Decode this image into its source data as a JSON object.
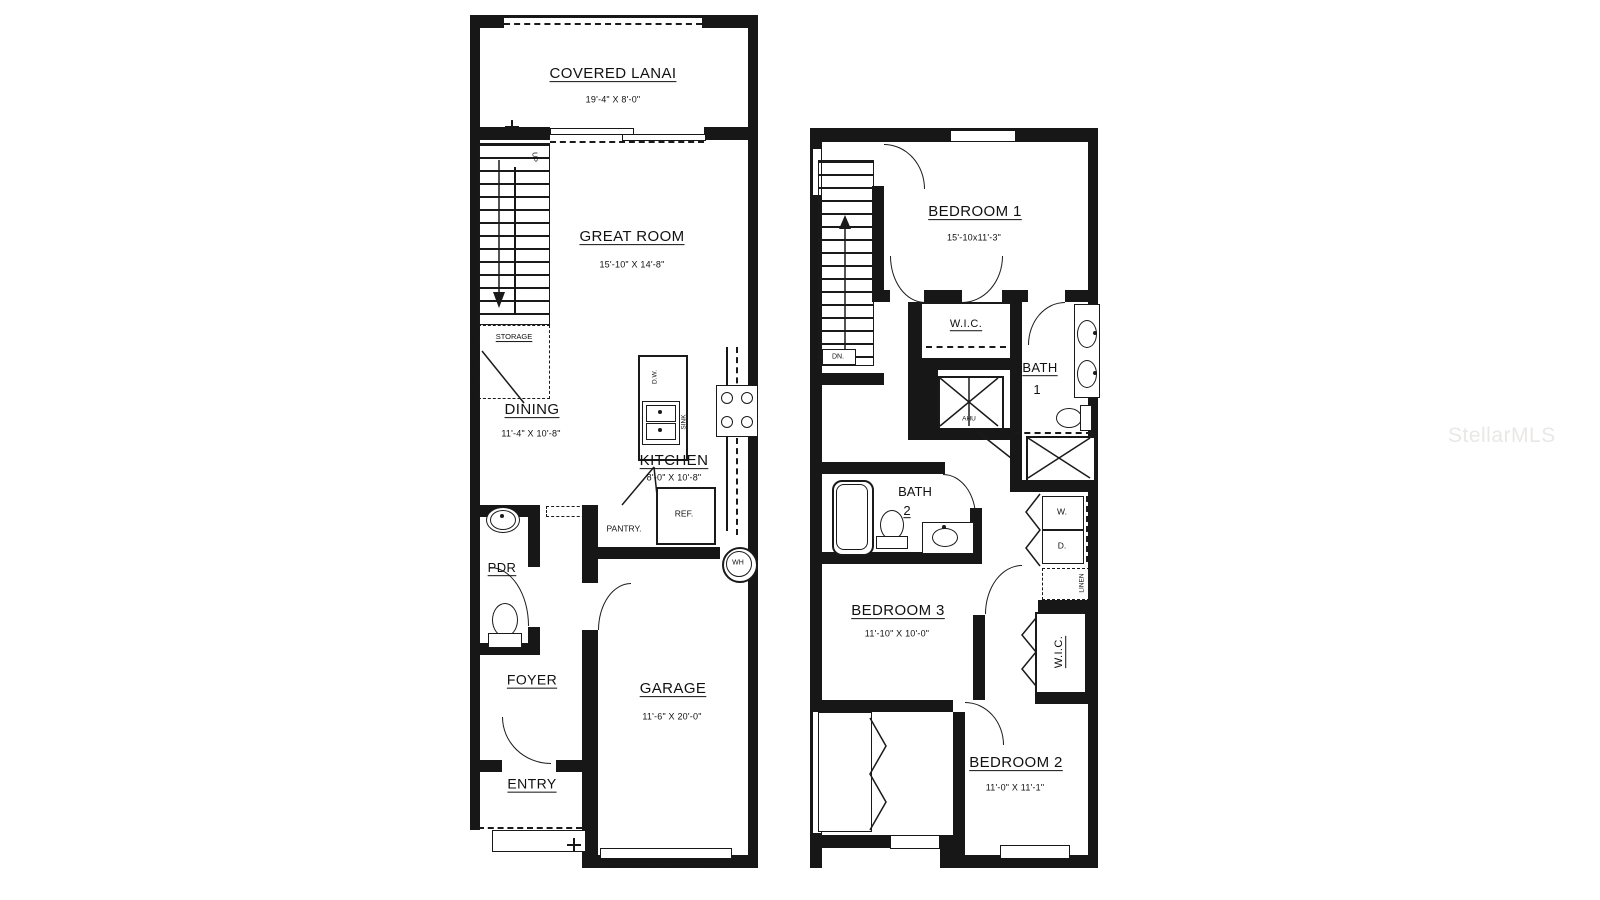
{
  "watermark": "StellarMLS",
  "floor1": {
    "covered_lanai": {
      "name": "COVERED LANAI",
      "dims": "19'-4\" X 8'-0\""
    },
    "great_room": {
      "name": "GREAT ROOM",
      "dims": "15'-10\" X 14'-8\""
    },
    "dining": {
      "name": "DINING",
      "dims": "11'-4\" X 10'-8\""
    },
    "kitchen": {
      "name": "KITCHEN",
      "dims": "8'-0\" X 10'-8\""
    },
    "pdr": {
      "name": "PDR"
    },
    "foyer": {
      "name": "FOYER"
    },
    "entry": {
      "name": "ENTRY"
    },
    "garage": {
      "name": "GARAGE",
      "dims": "11'-6\" X 20'-0\""
    },
    "labels": {
      "up": "UP",
      "storage": "STORAGE",
      "pantry": "PANTRY.",
      "ref": "REF.",
      "wh": "WH",
      "dw": "D.W.",
      "sink": "SINK"
    }
  },
  "floor2": {
    "bedroom1": {
      "name": "BEDROOM 1",
      "dims": "15'-10x11'-3\""
    },
    "bedroom2": {
      "name": "BEDROOM 2",
      "dims": "11'-0\" X 11'-1\""
    },
    "bedroom3": {
      "name": "BEDROOM 3",
      "dims": "11'-10\" X 10'-0\""
    },
    "bath1": {
      "name": "BATH",
      "num": "1"
    },
    "bath2": {
      "name": "BATH",
      "num": "2"
    },
    "wic_bedroom1": {
      "name": "W.I.C."
    },
    "wic_bedroom2": {
      "name": "W.I.C."
    },
    "labels": {
      "dn": "DN.",
      "ahu": "AHU",
      "washer": "W.",
      "dryer": "D.",
      "linen": "LINEN"
    }
  }
}
